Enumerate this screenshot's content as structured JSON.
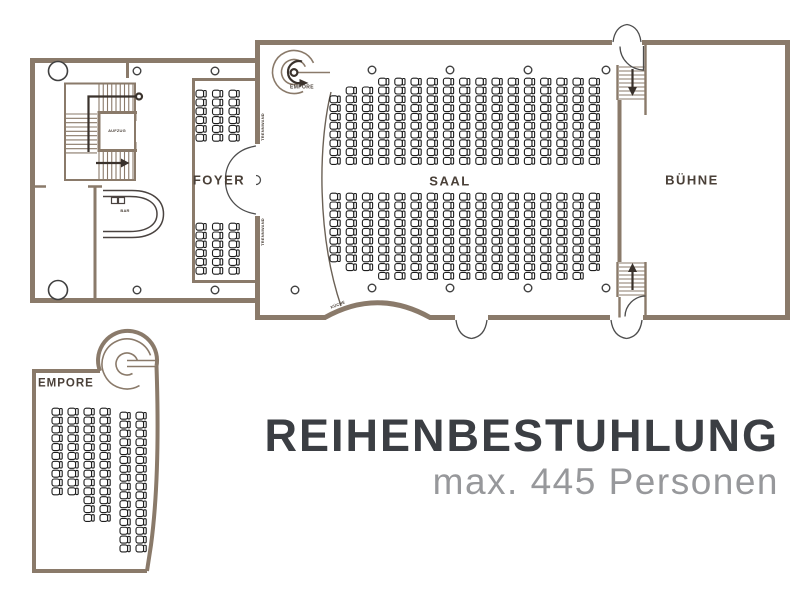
{
  "heading": {
    "title": "REIHENBESTUHLUNG",
    "subtitle": "max. 445 Personen"
  },
  "labels": {
    "foyer": "FOYER",
    "saal": "SAAL",
    "buehne": "BÜHNE",
    "empore_stair": "EMPORE",
    "empore_plan": "EMPORE",
    "aufzug": "AUFZUG",
    "bar": "BAR",
    "kueche": "KÜCHE",
    "trennwand_upper": "TRENNWAND",
    "trennwand_lower": "TRENNWAND"
  },
  "colors": {
    "wall": "#8a7a6a",
    "door": "#4d4d4d",
    "seat_stroke": "#1d1d1d",
    "arrow": "#3a322c",
    "label": "#4a4038",
    "title": "#3b3e43",
    "subtitle": "#97989b",
    "curved_wall": "#6b6156",
    "bar_counter": "#4a4340",
    "column_stroke": "#3f3f3f"
  },
  "seating": {
    "total_persons": 445,
    "blocks": [
      {
        "id": "saal-upper",
        "x": 330,
        "col_pitch": 16.2,
        "row_pitch": 8.8,
        "align": "bottom",
        "base_y": 166,
        "cols": [
          8,
          9,
          9,
          10,
          10,
          10,
          10,
          10,
          10,
          10,
          10,
          10,
          10,
          10,
          10,
          10,
          10
        ]
      },
      {
        "id": "saal-lower",
        "x": 330,
        "col_pitch": 16.2,
        "row_pitch": 8.8,
        "align": "top",
        "base_y": 193,
        "cols": [
          8,
          9,
          9,
          10,
          10,
          10,
          10,
          10,
          10,
          10,
          10,
          10,
          10,
          10,
          10,
          10,
          9
        ]
      },
      {
        "id": "foyer-upper",
        "x": 196,
        "col_pitch": 16.5,
        "row_pitch": 8.8,
        "align": "top",
        "base_y": 90,
        "cols": [
          6,
          6,
          6
        ]
      },
      {
        "id": "foyer-lower",
        "x": 196,
        "col_pitch": 16.5,
        "row_pitch": 8.8,
        "align": "top",
        "base_y": 223,
        "cols": [
          6,
          6,
          6
        ]
      },
      {
        "id": "empore",
        "col_x": [
          52,
          68,
          84,
          100,
          120,
          136
        ],
        "row_pitch": 8.85,
        "align": "top",
        "base_y": 408,
        "col_y_offsets": [
          0,
          0,
          0,
          0,
          4,
          4
        ],
        "cols": [
          10,
          10,
          13,
          13,
          16,
          16
        ]
      }
    ]
  },
  "structure": {
    "columns_large": [
      [
        58,
        71
      ],
      [
        58,
        290
      ]
    ],
    "columns_small": [
      [
        137,
        71
      ],
      [
        215,
        71
      ],
      [
        372,
        70
      ],
      [
        450,
        70
      ],
      [
        528,
        70
      ],
      [
        606,
        70
      ],
      [
        137,
        290
      ],
      [
        215,
        290
      ],
      [
        295,
        290
      ],
      [
        372,
        288
      ],
      [
        450,
        288
      ],
      [
        528,
        288
      ],
      [
        606,
        288
      ]
    ]
  }
}
